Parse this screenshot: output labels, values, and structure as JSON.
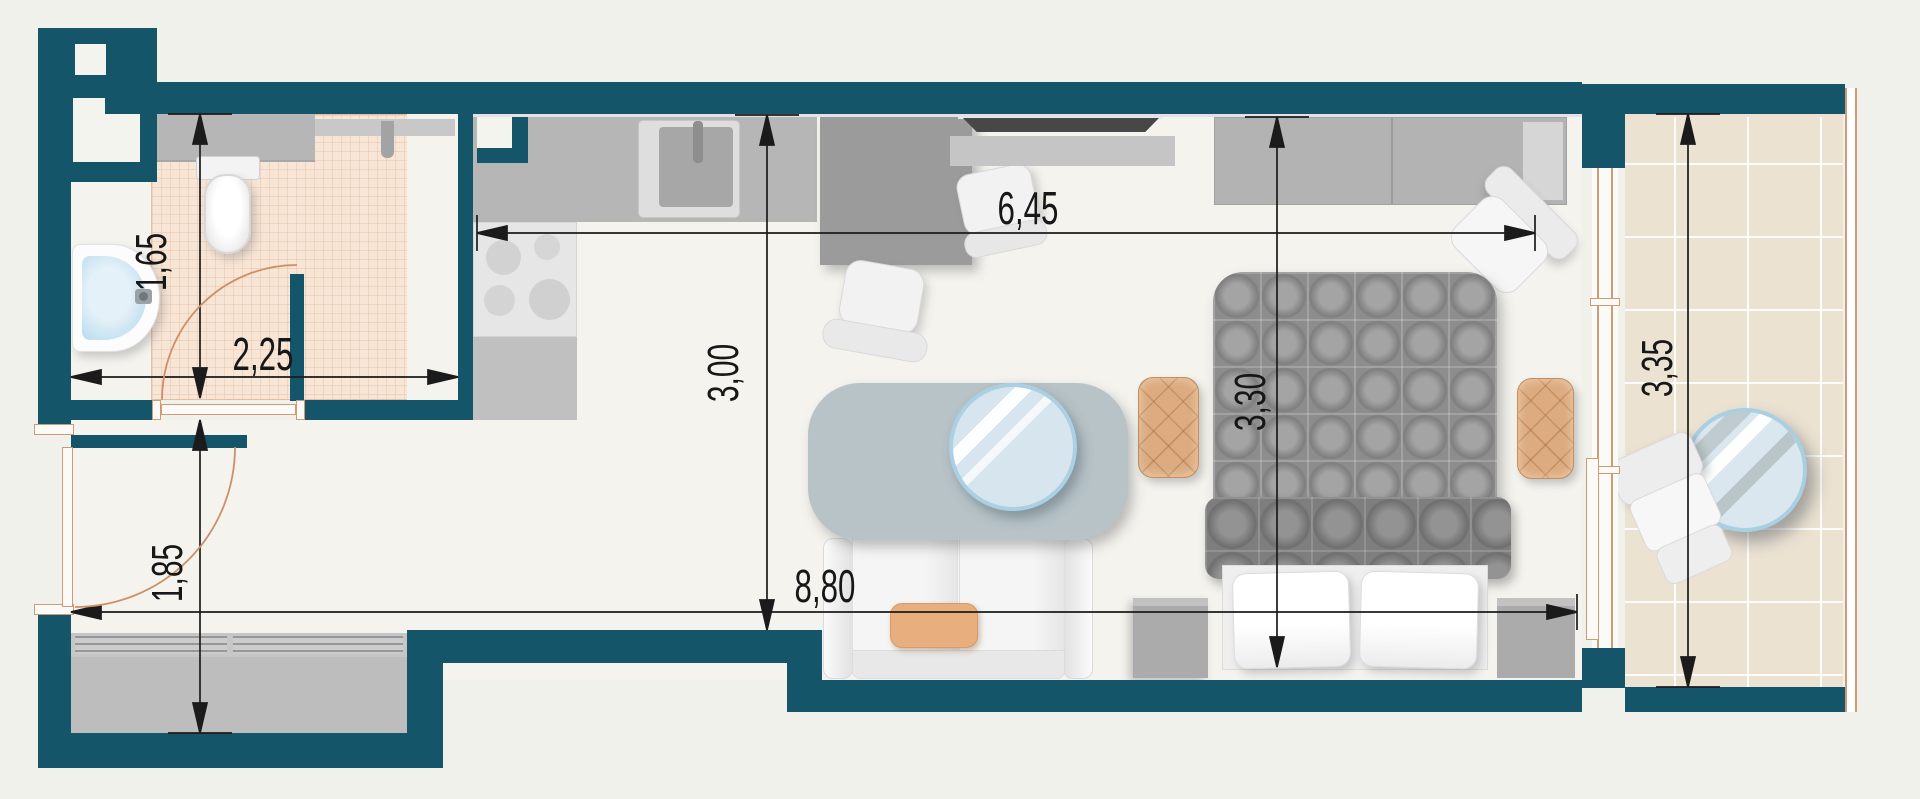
{
  "title": "Studio apartment floor plan",
  "colors": {
    "wall": "#14556a",
    "background": "#f1f1ec",
    "floor": "#f4f3ee",
    "bathroom_tile": "#f7e5d6",
    "balcony_tile": "#ebe2d2",
    "dimension_line": "#1b1b1b",
    "door_swing": "#cf8f66",
    "accent_upholstery": "#dcab80",
    "glass": "#d7e6ee"
  },
  "dimensions": {
    "bathroom_depth": {
      "label": "1,65",
      "meters": 1.65,
      "orientation": "vertical"
    },
    "bathroom_width": {
      "label": "2,25",
      "meters": 2.25,
      "orientation": "horizontal"
    },
    "hallway_depth": {
      "label": "1,85",
      "meters": 1.85,
      "orientation": "vertical"
    },
    "living_depth_left": {
      "label": "3,00",
      "meters": 3.0,
      "orientation": "vertical"
    },
    "living_width": {
      "label": "6,45",
      "meters": 6.45,
      "orientation": "horizontal"
    },
    "apartment_length": {
      "label": "8,80",
      "meters": 8.8,
      "orientation": "horizontal"
    },
    "living_depth_right": {
      "label": "3,30",
      "meters": 3.3,
      "orientation": "vertical"
    },
    "balcony_length": {
      "label": "3,35",
      "meters": 3.35,
      "orientation": "vertical"
    }
  },
  "furniture": [
    "toilet",
    "washbasin",
    "bathroom-counter",
    "towel-hook",
    "kitchen-counter",
    "kitchen-sink",
    "stove",
    "base-cabinet",
    "desk",
    "office-chair",
    "side-chair",
    "tv",
    "tv-console",
    "wardrobe",
    "accent-chair",
    "double-bed",
    "duvet",
    "pillow",
    "bedside-pouf",
    "nightstand",
    "sofa",
    "sofa-cushion",
    "coffee-table",
    "sliding-wardrobe",
    "entrance-door",
    "bathroom-door",
    "balcony-glazing",
    "balcony-table",
    "lounge-chair"
  ]
}
